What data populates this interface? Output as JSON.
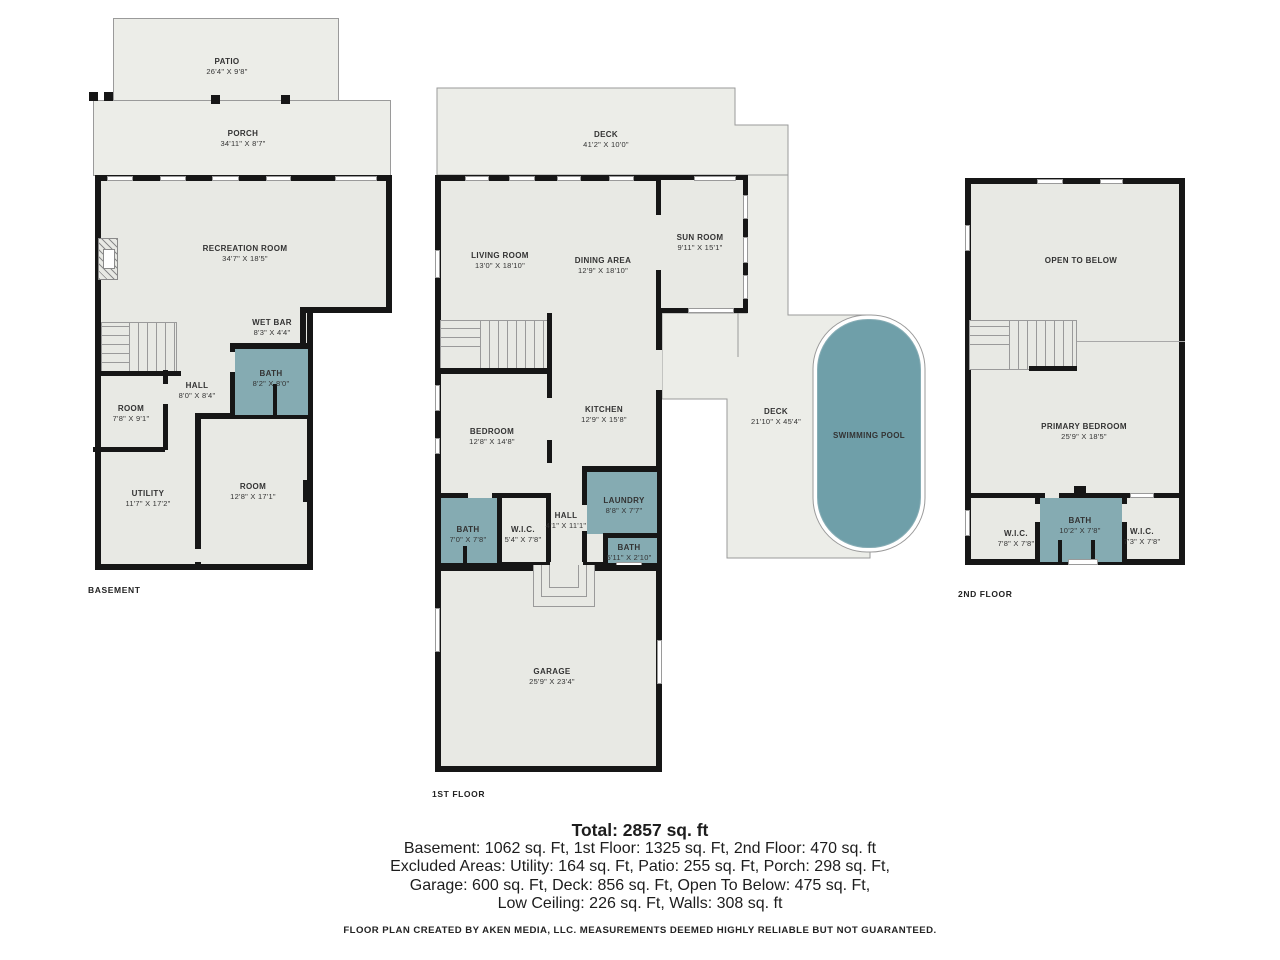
{
  "plans": {
    "basement": {
      "label": "BASEMENT",
      "rooms": {
        "patio": {
          "name": "PATIO",
          "dims": "26'4\" X 9'8\""
        },
        "porch": {
          "name": "PORCH",
          "dims": "34'11\" X 8'7\""
        },
        "recreation": {
          "name": "RECREATION ROOM",
          "dims": "34'7\" X 18'5\""
        },
        "wetbar": {
          "name": "WET BAR",
          "dims": "8'3\" X 4'4\""
        },
        "bath": {
          "name": "BATH",
          "dims": "8'2\" X 8'0\""
        },
        "hall": {
          "name": "HALL",
          "dims": "8'0\" X 8'4\""
        },
        "room1": {
          "name": "ROOM",
          "dims": "7'8\" X 9'1\""
        },
        "utility": {
          "name": "UTILITY",
          "dims": "11'7\" X 17'2\""
        },
        "room2": {
          "name": "ROOM",
          "dims": "12'8\" X 17'1\""
        }
      }
    },
    "first": {
      "label": "1ST FLOOR",
      "rooms": {
        "deck_top": {
          "name": "DECK",
          "dims": "41'2\" X 10'0\""
        },
        "living": {
          "name": "LIVING ROOM",
          "dims": "13'0\" X 18'10\""
        },
        "dining": {
          "name": "DINING AREA",
          "dims": "12'9\" X 18'10\""
        },
        "sunroom": {
          "name": "SUN ROOM",
          "dims": "9'11\" X 15'1\""
        },
        "kitchen": {
          "name": "KITCHEN",
          "dims": "12'9\" X 15'8\""
        },
        "bedroom": {
          "name": "BEDROOM",
          "dims": "12'8\" X 14'8\""
        },
        "bath1": {
          "name": "BATH",
          "dims": "7'0\" X 7'8\""
        },
        "wic": {
          "name": "W.I.C.",
          "dims": "5'4\" X 7'8\""
        },
        "hall": {
          "name": "HALL",
          "dims": "4'1\" X 11'1\""
        },
        "laundry": {
          "name": "LAUNDRY",
          "dims": "8'8\" X 7'7\""
        },
        "bath2": {
          "name": "BATH",
          "dims": "5'11\" X 2'10\""
        },
        "deck_right": {
          "name": "DECK",
          "dims": "21'10\" X 45'4\""
        },
        "pool": {
          "name": "SWIMMING POOL",
          "dims": ""
        },
        "garage": {
          "name": "GARAGE",
          "dims": "25'9\" X 23'4\""
        }
      }
    },
    "second": {
      "label": "2ND FLOOR",
      "rooms": {
        "open": {
          "name": "OPEN TO BELOW",
          "dims": ""
        },
        "primary": {
          "name": "PRIMARY BEDROOM",
          "dims": "25'9\" X 18'5\""
        },
        "wic_left": {
          "name": "W.I.C.",
          "dims": "7'8\" X 7'8\""
        },
        "bath": {
          "name": "BATH",
          "dims": "10'2\" X 7'8\""
        },
        "wic_right": {
          "name": "W.I.C.",
          "dims": "7'3\" X 7'8\""
        }
      }
    }
  },
  "summary": {
    "total": "Total: 2857 sq. ft",
    "line1": "Basement: 1062 sq. Ft, 1st Floor: 1325 sq. Ft, 2nd Floor: 470 sq. ft",
    "line2": "Excluded Areas: Utility: 164 sq. Ft, Patio: 255 sq. Ft, Porch: 298 sq. Ft,",
    "line3": "Garage: 600 sq. Ft, Deck: 856 sq. Ft, Open To Below: 475 sq. Ft,",
    "line4": "Low Ceiling: 226 sq. Ft, Walls: 308 sq. ft",
    "disclaimer": "FLOOR PLAN CREATED BY AKEN MEDIA, LLC. MEASUREMENTS DEEMED HIGHLY RELIABLE BUT NOT GUARANTEED."
  },
  "colors": {
    "wall": "#161616",
    "floor": "#e8e9e4",
    "outdoor": "#ecede8",
    "wet": "#85abb2",
    "pool": "#6f9fa9",
    "line": "#9a9a9a"
  }
}
